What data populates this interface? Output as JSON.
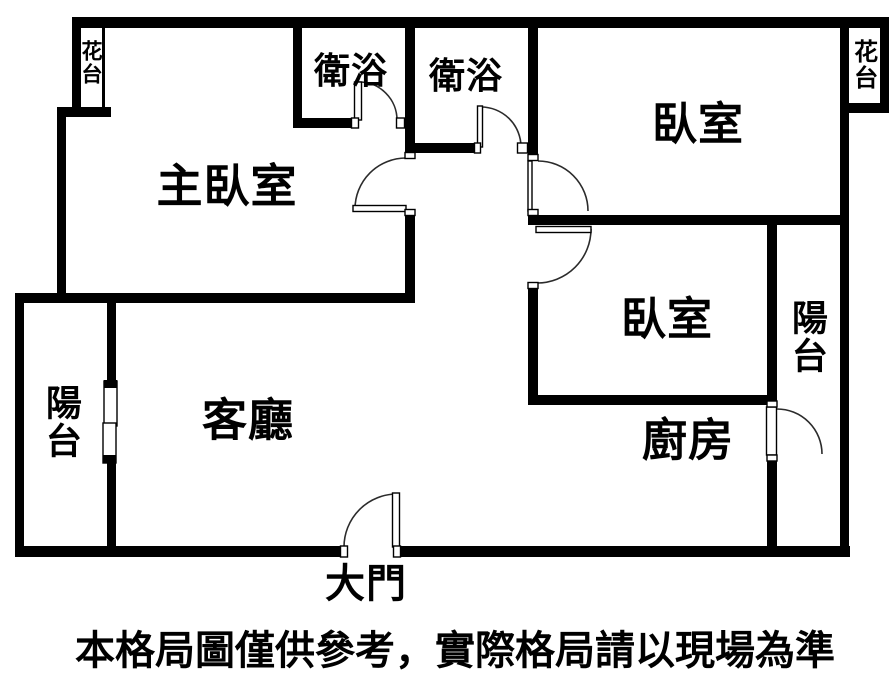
{
  "labels": {
    "master_bedroom": "主臥室",
    "bathroom_1": "衛浴",
    "bathroom_2": "衛浴",
    "bedroom_top": "臥室",
    "bedroom_mid": "臥室",
    "living_room": "客廳",
    "kitchen": "廚房",
    "balcony_left": "陽台",
    "balcony_right": "陽台",
    "flower_left": "花台",
    "flower_right": "花台",
    "main_door": "大門"
  },
  "disclaimer": "本格局圖僅供參考，實際格局請以現場為準",
  "colors": {
    "wall": "#000000",
    "background": "#ffffff",
    "door_line": "#333333"
  }
}
